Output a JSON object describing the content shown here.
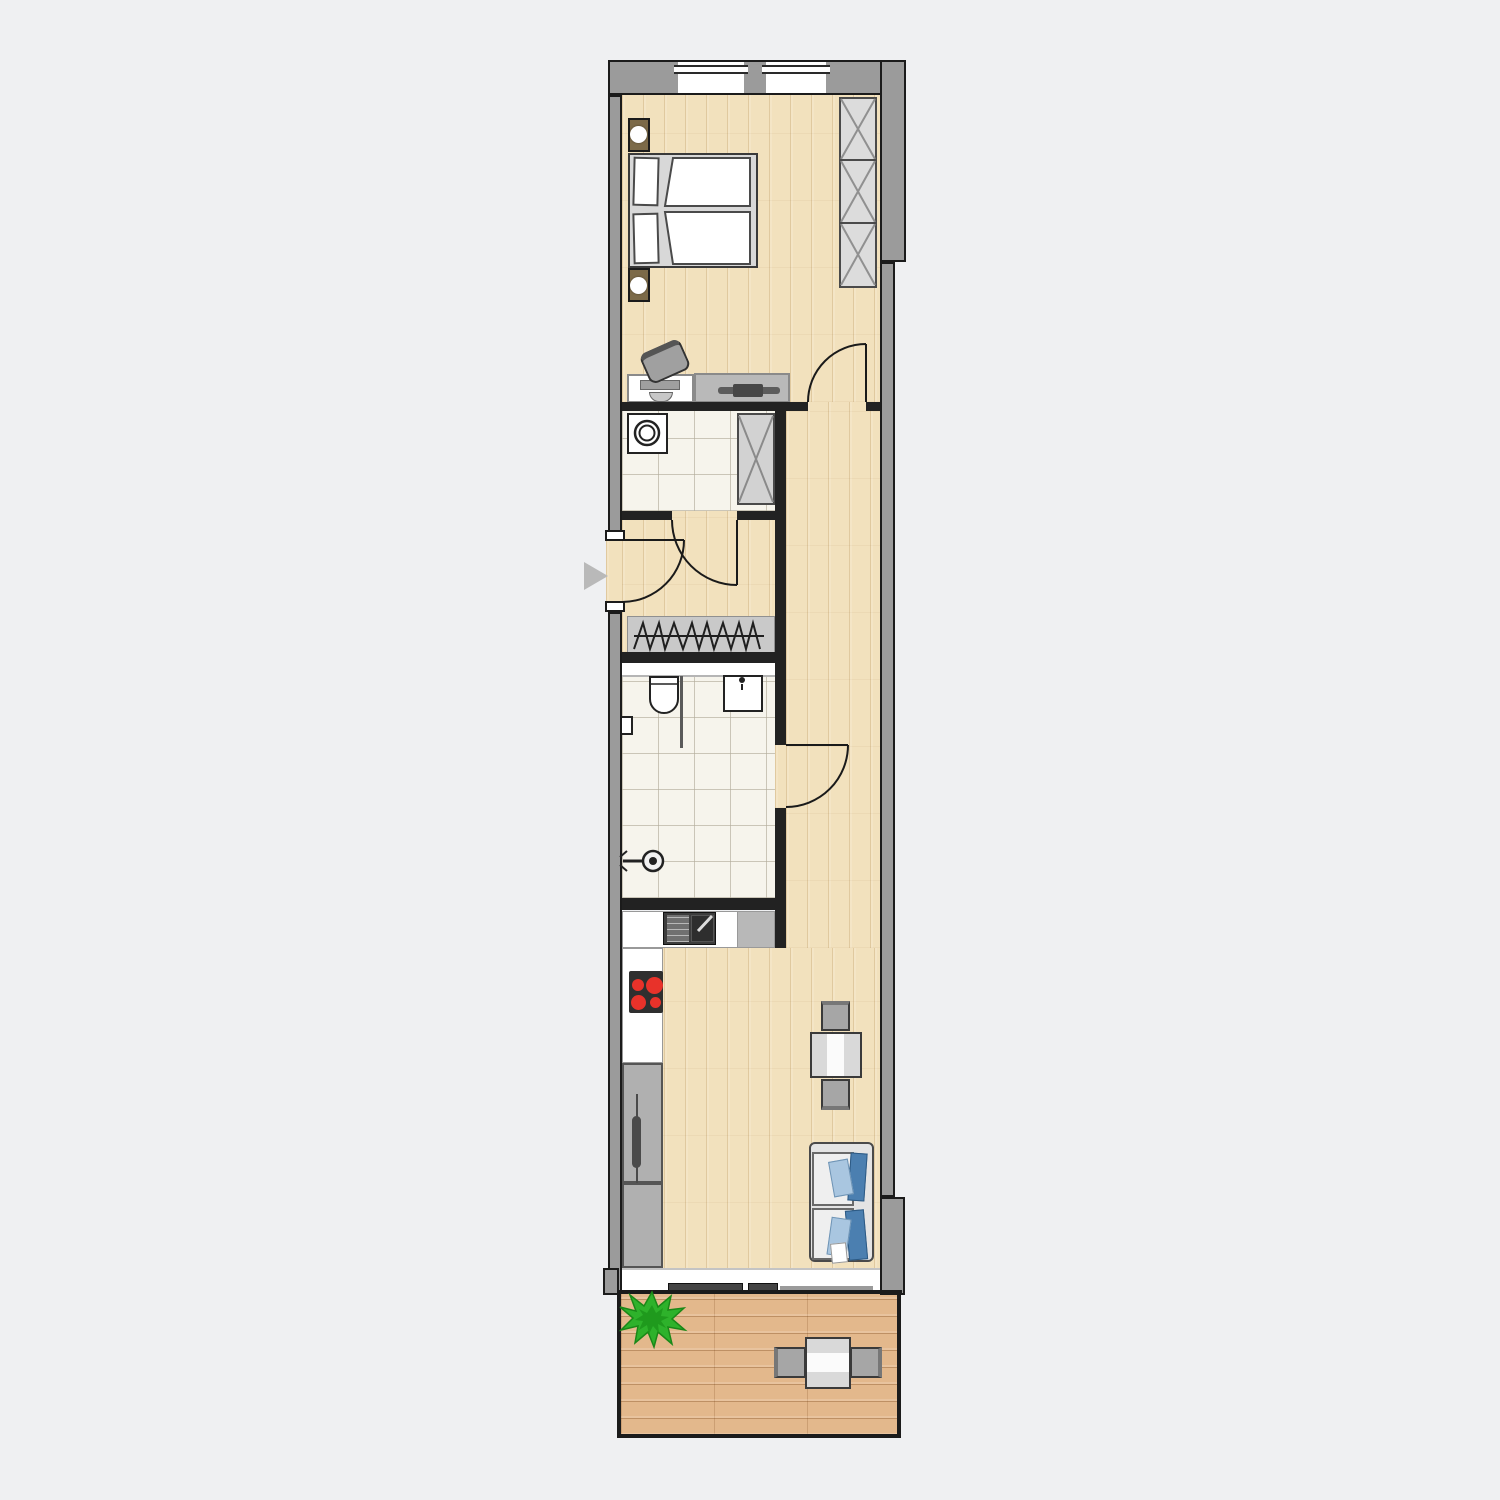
{
  "canvas": {
    "width": 1500,
    "height": 1500,
    "background": "#eff0f2"
  },
  "plan": {
    "type": "apartment-floor-plan",
    "orientation": "vertical-strip",
    "entrance_marker": {
      "shape": "triangle-right",
      "color": "#b9b9b9"
    },
    "palette": {
      "exterior_wall_fill": "#9b9b9b",
      "wall_outline": "#1b1b1b",
      "interior_wall": "#222222",
      "wood_floor": "#f2e1bd",
      "balcony_deck": "#e3b88c",
      "tile_floor": "#f6f4ec",
      "furniture_light": "#d9d9d9",
      "furniture_mid": "#a6a6a6",
      "furniture_dark": "#4a4a4a",
      "nightstand_brown": "#7c6a48",
      "cooktop_black": "#2f2f2f",
      "burner_red": "#e8322a",
      "cushion_blue_dark": "#4b7fb0",
      "cushion_blue_light": "#a9c6e0",
      "plant_green": "#2eb22b"
    },
    "rooms": [
      {
        "id": "bedroom",
        "floor": "wood",
        "furniture": [
          "double-bed",
          "pillows",
          "duvets",
          "nightstand-with-lamp",
          "nightstand-with-lamp",
          "wardrobe-3-sections",
          "desk-with-monitor",
          "office-chair",
          "sideboard-with-tv"
        ]
      },
      {
        "id": "utility-room",
        "floor": "tile",
        "furniture": [
          "washing-machine",
          "cabinet-x"
        ]
      },
      {
        "id": "entrance-hall",
        "floor": "wood",
        "furniture": [
          "coat-rack"
        ]
      },
      {
        "id": "bathroom",
        "floor": "tile",
        "furniture": [
          "shelf",
          "toilet",
          "washbasin",
          "shower-head",
          "wall-radiator",
          "glass-partition"
        ]
      },
      {
        "id": "kitchen-living-room",
        "floor": "wood",
        "furniture": [
          "kitchen-counter",
          "kitchen-sink-with-drainer",
          "cooktop-4-burners",
          "tall-cabinet-with-handle",
          "refrigerator-cabinet",
          "dining-table",
          "dining-chair",
          "dining-chair",
          "sofa-with-cushions"
        ]
      },
      {
        "id": "balcony",
        "floor": "wood-decking",
        "furniture": [
          "potted-plant",
          "outdoor-table",
          "outdoor-chair",
          "outdoor-chair"
        ]
      }
    ],
    "openings": {
      "windows": [
        "bedroom-window-left",
        "bedroom-window-right"
      ],
      "doors": [
        "entrance-door",
        "bedroom-door",
        "utility-room-door",
        "bathroom-door",
        "balcony-sliding-door"
      ]
    }
  }
}
